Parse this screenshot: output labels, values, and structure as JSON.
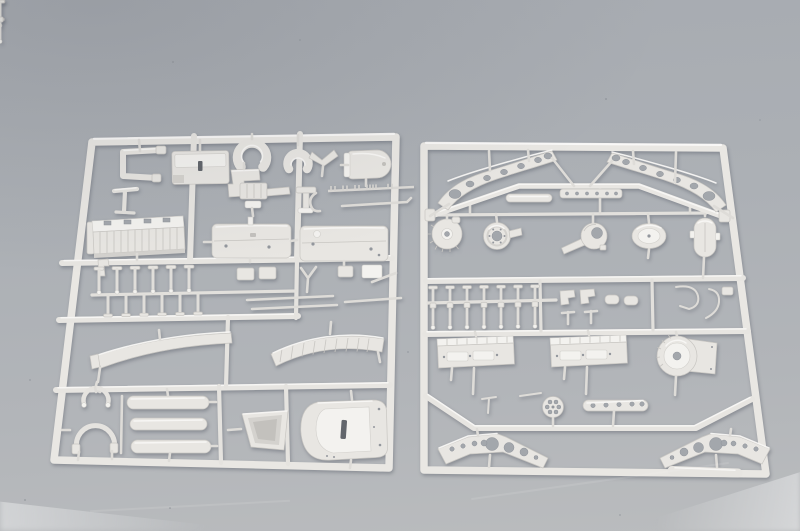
{
  "scene": {
    "type": "product-photo",
    "description": "Two light-grey injection-moulded plastic model-kit sprues (part trees) lying side by side on a blue-grey studio surface",
    "palette": {
      "bg-top": "#a7abb1",
      "bg-mid": "#b2b5b9",
      "bg-bottom": "#babcbe",
      "plastic": "#e9e7e3",
      "plastic-light": "#f6f5f2",
      "plastic-shade": "#cbc9c5",
      "hole": "#a3a7ac",
      "slot": "#62666c"
    },
    "sprues": [
      {
        "id": "left-sprue",
        "label": "Sprue A - engine block, fuel tanks, fenders, hood and small fittings",
        "parts": [
          "c-channel-bracket",
          "slotted-plate",
          "horseshoe-clamp-large",
          "horseshoe-clamp-small",
          "v-bracket",
          "round-end-tank",
          "stand-bracket",
          "step-bracket",
          "engine-accessory-blocks",
          "t-bracket",
          "ticked-rod",
          "hook-pipe",
          "ribbed-engine-block",
          "fuel-tank-left",
          "fuel-tank-right",
          "t-pin-row-upper",
          "t-pin-row-lower",
          "linkage-plates",
          "y-linkage",
          "thin-rods",
          "smooth-fender",
          "louvered-fender",
          "wishbone-small",
          "wishbone-large",
          "cylinder-tubes",
          "bucket-scoop",
          "rounded-hood"
        ]
      },
      {
        "id": "right-sprue",
        "label": "Sprue B - chassis wing frames, axle hubs, drums, axle pins and lower frames",
        "parts": [
          "wing-frame-left",
          "wing-frame-right",
          "bent-chassis-rail",
          "pill-bar",
          "slotted-bar",
          "ribbed-drum",
          "axle-hub",
          "backing-plate-with-arm",
          "oval-cover",
          "capsule-housing",
          "axle-pin-row",
          "l-brackets",
          "small-cylinders",
          "wire-hooks",
          "detail-plate-left",
          "detail-plate-right",
          "winch-drum",
          "fork-pin",
          "spoked-wheel-small",
          "slotted-slat",
          "lower-wing-frame-left",
          "lower-wing-frame-right",
          "gate-bar"
        ]
      }
    ]
  }
}
